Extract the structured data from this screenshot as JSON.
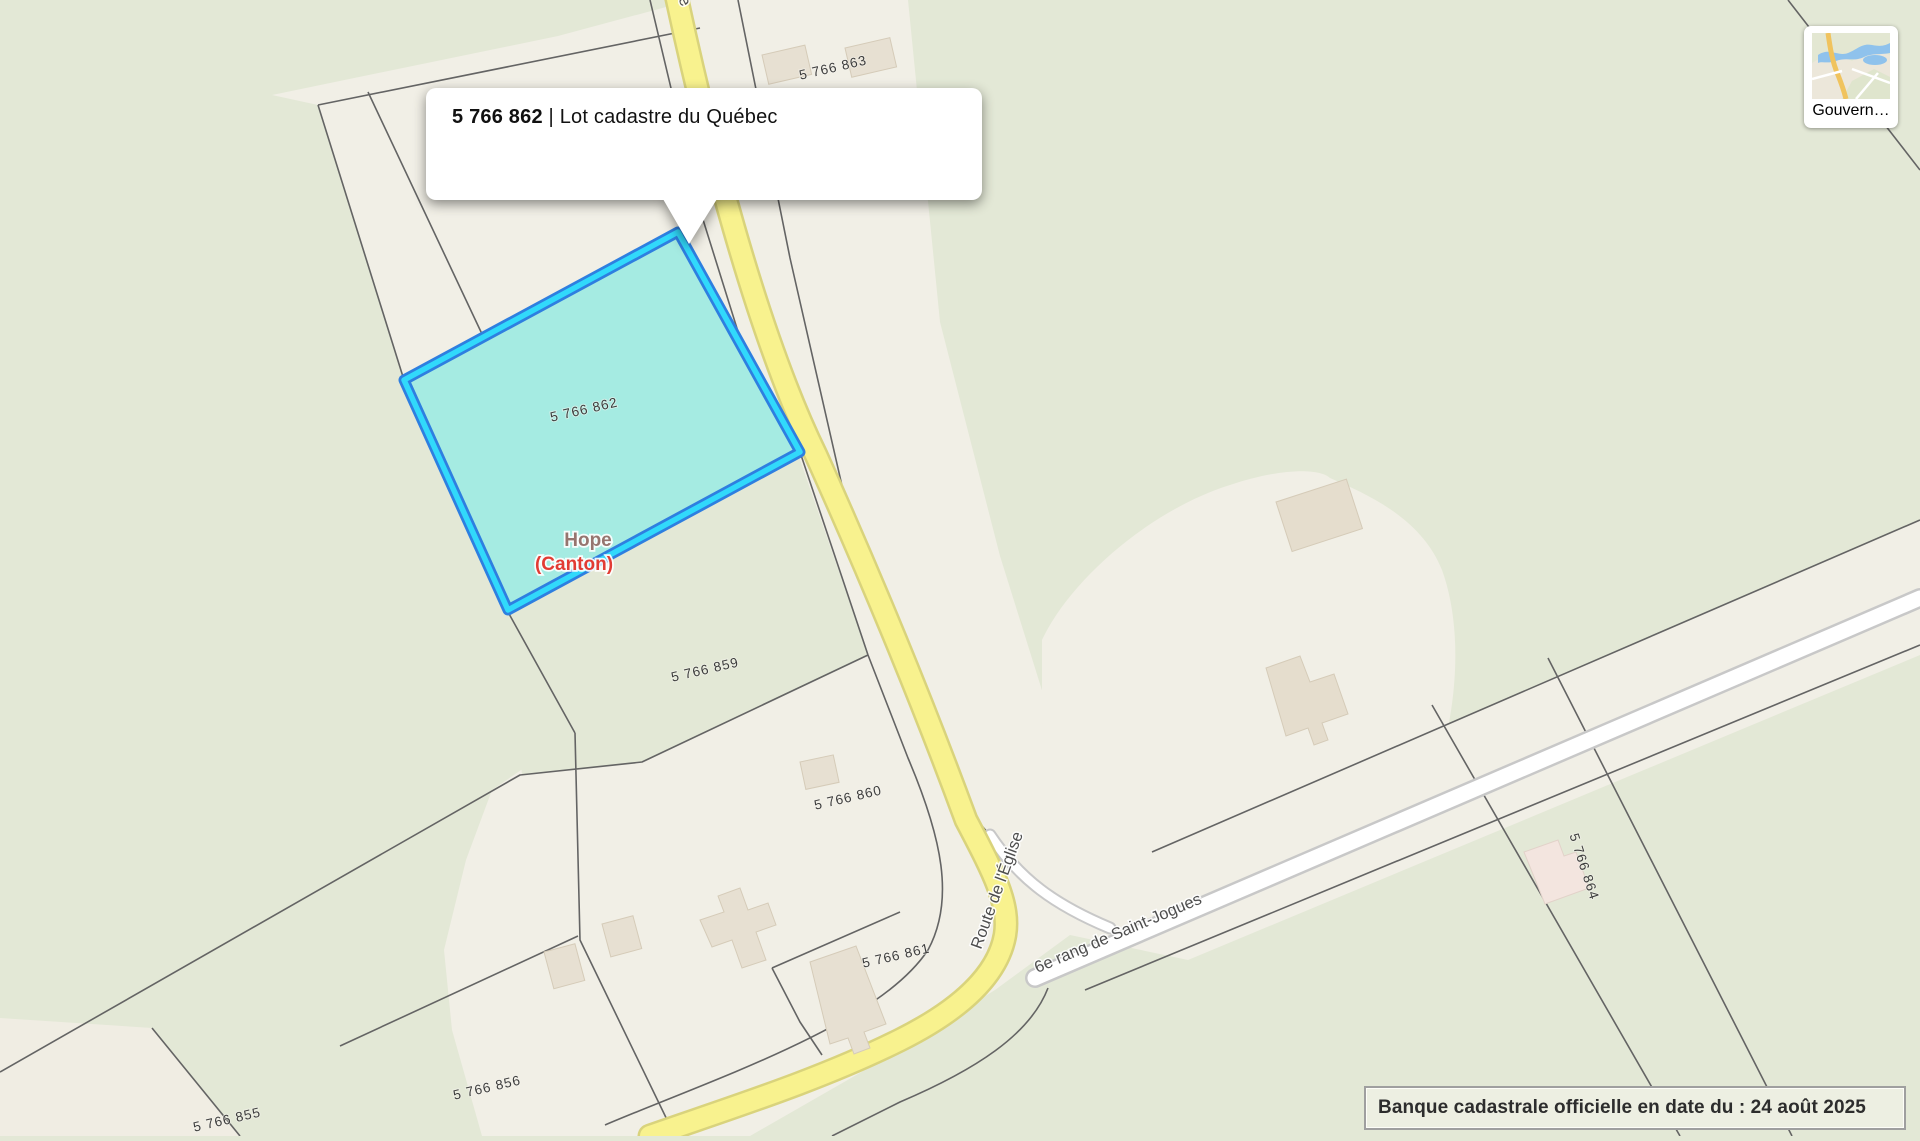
{
  "map": {
    "popup": {
      "lot_number": "5 766 862",
      "separator": "|",
      "description": "Lot cadastre du Québec"
    },
    "selected_lot": {
      "number": "5 766 862"
    },
    "place_label": {
      "line1": "Hope",
      "line2": "(Canton)"
    },
    "road_labels": {
      "route_eglise": "Route de l'Église",
      "rang_saint_jogues": "6e rang de Saint-Jogues"
    },
    "lot_labels": [
      {
        "id": "lot-5766863",
        "text": "5 766 863"
      },
      {
        "id": "lot-5766862",
        "text": "5 766 862"
      },
      {
        "id": "lot-5766859",
        "text": "5 766 859"
      },
      {
        "id": "lot-5766860",
        "text": "5 766 860"
      },
      {
        "id": "lot-5766861",
        "text": "5 766 861"
      },
      {
        "id": "lot-5766864",
        "text": "5 766 864"
      },
      {
        "id": "lot-5766856",
        "text": "5 766 856"
      },
      {
        "id": "lot-5766855",
        "text": "5 766 855"
      }
    ],
    "thumbnail": {
      "label": "Gouvern…"
    },
    "attribution": {
      "text": "Banque cadastrale officielle en date du : 24 août 2025"
    },
    "colors": {
      "background_green": "#e3e8d6",
      "parcel_beige": "#f1efe6",
      "selected_fill": "#a5ebe2",
      "selected_border_outer": "#2e7fe0",
      "selected_border_inner": "#31d9fb",
      "road_primary_fill": "#f8f28e",
      "road_primary_casing": "#d9d37c",
      "road_secondary_fill": "#ffffff",
      "road_secondary_casing": "#c8c8c8",
      "place_name_color": "#96756f",
      "place_type_color": "#e23c34"
    }
  }
}
